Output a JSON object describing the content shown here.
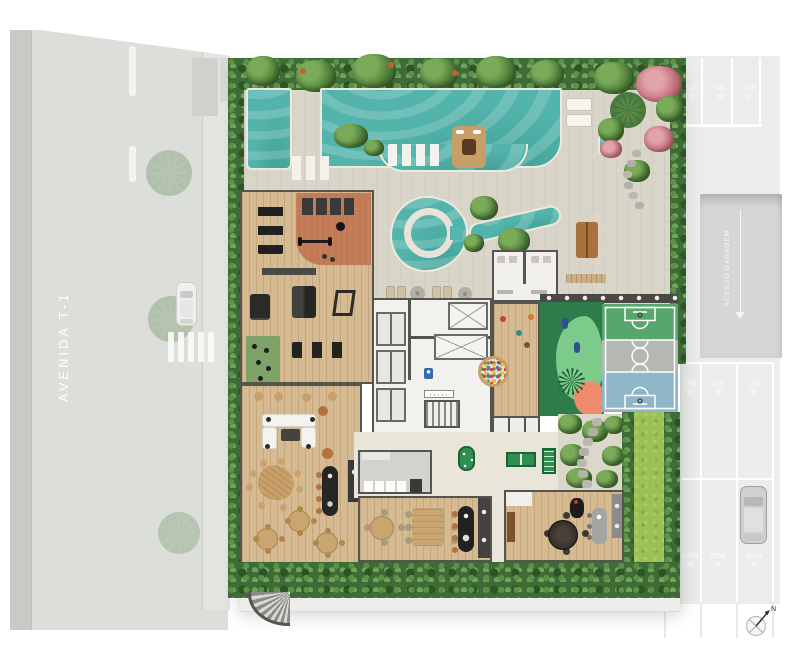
{
  "street": {
    "name": "AVENIDA T-1"
  },
  "parking": {
    "upper_stalls": [
      {
        "num": "130",
        "tag": "Ⓜ"
      },
      {
        "num": "131",
        "tag": "Ⓜ"
      },
      {
        "num": "132",
        "tag": "Ⓜ"
      }
    ],
    "lower_stalls_row1": [
      {
        "num": "106",
        "tag": "Ⓜ"
      },
      {
        "num": "105",
        "tag": "Ⓜ"
      },
      {
        "num": "104",
        "tag": "Ⓜ"
      }
    ],
    "lower_stalls_row2": [
      {
        "num": "106A",
        "tag": "Ⓜ"
      },
      {
        "num": "105A",
        "tag": "Ⓜ"
      },
      {
        "num": "104A",
        "tag": "Ⓜ"
      }
    ],
    "ramp_label": "ACESSO GARAGEM"
  },
  "compass": {
    "north": "N"
  },
  "colors": {
    "pool": "#53b4ab",
    "deck": "#d9d5c8",
    "wood": "#d6bb92",
    "hedge": "#3e6b36",
    "lawn": "#9dc055",
    "terracotta": "#c27a55",
    "court_green": "#57a66d",
    "court_gray": "#b5b8b2",
    "court_blue": "#8fb5c8",
    "playground_green": "#2e7c49",
    "playground_light": "#7ccb8b",
    "coral": "#ef8a6b",
    "street": "#dcdeda",
    "parking": "#ebedeb"
  }
}
